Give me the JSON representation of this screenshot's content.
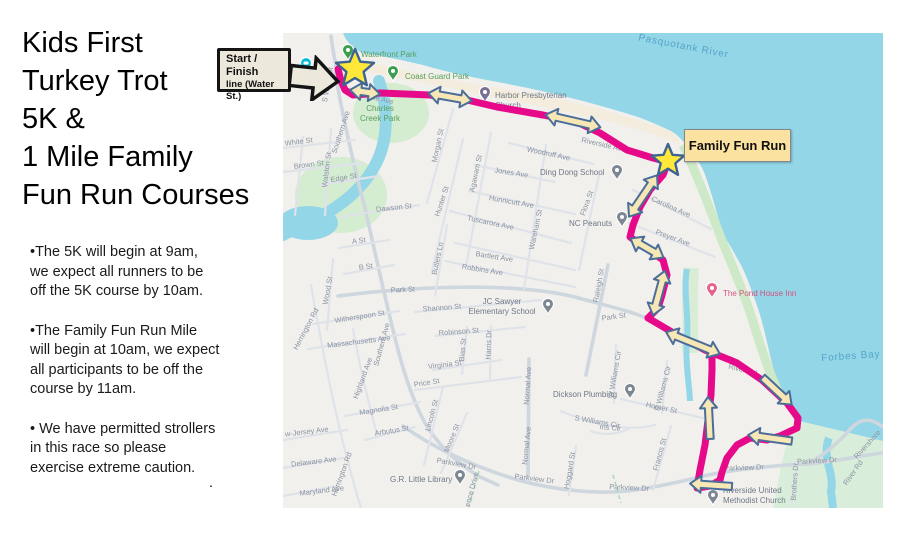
{
  "left_panel": {
    "title_lines": [
      "Kids First",
      "Turkey Trot",
      "5K &",
      "1 Mile Family",
      "Fun Run Courses"
    ],
    "bullets": [
      [
        "•The 5K will begin at 9am,",
        "we expect all runners to be",
        "off the 5K course by 10am."
      ],
      [
        "•The Family Fun Run Mile",
        "will begin at 10am, we expect",
        "all participants to be off the",
        "course by 11am."
      ],
      [
        "• We have permitted strollers",
        "in this race so please",
        "exercise extreme caution."
      ]
    ],
    "stray_period": "."
  },
  "annotations": {
    "start_finish_callout_lines": [
      "Start / Finish",
      "line (Water",
      "St.)"
    ],
    "family_fun_run_label": "Family Fun Run"
  },
  "map": {
    "colors": {
      "land": "#f1f0ed",
      "water": "#93d6e8",
      "park_green": "#d4ecd0",
      "shore_green": "#cde9c8",
      "beach_cream": "#f4ecdc",
      "road_minor": "#dfe3e9",
      "road_major": "#ced6de",
      "route_pink": "#e60a8a",
      "arrow_fill": "#f6e7b4",
      "arrow_stroke": "#4b6d99",
      "star_fill": "#ffe83a",
      "star_stroke": "#3f6391"
    },
    "water_labels": [
      {
        "t": "Pasquotank River",
        "x": 400,
        "y": 16,
        "r": 11
      },
      {
        "t": "Forbes Bay",
        "x": 568,
        "y": 326,
        "r": -4
      }
    ],
    "street_labels": [
      {
        "t": "S Water St",
        "x": 47,
        "y": 52,
        "r": -80
      },
      {
        "t": "Riverside Ave",
        "x": 88,
        "y": 66,
        "r": 14
      },
      {
        "t": "Riverside Ave",
        "x": 320,
        "y": 114,
        "r": 13
      },
      {
        "t": "Southern Ave",
        "x": 60,
        "y": 100,
        "r": -72
      },
      {
        "t": "Southern Ave",
        "x": 101,
        "y": 312,
        "r": -75
      },
      {
        "t": "Walston St",
        "x": 46,
        "y": 137,
        "r": -83
      },
      {
        "t": "White St",
        "x": 16,
        "y": 111,
        "r": -7
      },
      {
        "t": "Brown St",
        "x": 26,
        "y": 134,
        "r": -7
      },
      {
        "t": "Edge St",
        "x": 61,
        "y": 147,
        "r": -10
      },
      {
        "t": "Dawson St",
        "x": 111,
        "y": 177,
        "r": -6
      },
      {
        "t": "A St",
        "x": 76,
        "y": 210,
        "r": -7
      },
      {
        "t": "B St",
        "x": 83,
        "y": 236,
        "r": -7
      },
      {
        "t": "Morgan St",
        "x": 157,
        "y": 113,
        "r": -78
      },
      {
        "t": "Hunter St",
        "x": 161,
        "y": 169,
        "r": -72
      },
      {
        "t": "Butlers Ln",
        "x": 157,
        "y": 226,
        "r": -78
      },
      {
        "t": "Agawam St",
        "x": 195,
        "y": 141,
        "r": -78
      },
      {
        "t": "Jones Ave",
        "x": 228,
        "y": 142,
        "r": 9
      },
      {
        "t": "Hunnicutt Ave",
        "x": 228,
        "y": 171,
        "r": 10
      },
      {
        "t": "Tuscarora Ave",
        "x": 207,
        "y": 192,
        "r": 12
      },
      {
        "t": "Bartlett Ave",
        "x": 211,
        "y": 226,
        "r": 9
      },
      {
        "t": "Robbins Ave",
        "x": 199,
        "y": 239,
        "r": 9
      },
      {
        "t": "Woodruff Ave",
        "x": 265,
        "y": 123,
        "r": 12
      },
      {
        "t": "Wareham St",
        "x": 255,
        "y": 197,
        "r": -78
      },
      {
        "t": "Flora St",
        "x": 306,
        "y": 171,
        "r": -70
      },
      {
        "t": "Carolina Ave",
        "x": 387,
        "y": 176,
        "r": 24
      },
      {
        "t": "Preyer Ave",
        "x": 389,
        "y": 207,
        "r": 20
      },
      {
        "t": "Raleigh St",
        "x": 318,
        "y": 253,
        "r": -80
      },
      {
        "t": "Park St",
        "x": 120,
        "y": 259,
        "r": -3
      },
      {
        "t": "Park St",
        "x": 331,
        "y": 286,
        "r": -8
      },
      {
        "t": "Shannon St",
        "x": 159,
        "y": 277,
        "r": -4
      },
      {
        "t": "Witherspoon St",
        "x": 77,
        "y": 286,
        "r": -9
      },
      {
        "t": "Massachusetts Ave",
        "x": 76,
        "y": 311,
        "r": -7
      },
      {
        "t": "Herrington Rd",
        "x": 25,
        "y": 297,
        "r": -62
      },
      {
        "t": "Herrington Rd",
        "x": 61,
        "y": 442,
        "r": -70
      },
      {
        "t": "Wood St",
        "x": 47,
        "y": 258,
        "r": -80
      },
      {
        "t": "Highland Ave",
        "x": 82,
        "y": 346,
        "r": -70
      },
      {
        "t": "Robinson St",
        "x": 176,
        "y": 301,
        "r": -4
      },
      {
        "t": "Bias St",
        "x": 182,
        "y": 317,
        "r": -85
      },
      {
        "t": "Harris Dr",
        "x": 208,
        "y": 312,
        "r": -88
      },
      {
        "t": "Virginia St",
        "x": 162,
        "y": 334,
        "r": -7
      },
      {
        "t": "Price St",
        "x": 144,
        "y": 352,
        "r": -9
      },
      {
        "t": "Normal Ave",
        "x": 247,
        "y": 353,
        "r": -86
      },
      {
        "t": "Normal Ave",
        "x": 246,
        "y": 413,
        "r": -84
      },
      {
        "t": "Magnolia St",
        "x": 96,
        "y": 379,
        "r": -9
      },
      {
        "t": "Lincoln St",
        "x": 151,
        "y": 383,
        "r": -75
      },
      {
        "t": "Moore St",
        "x": 171,
        "y": 406,
        "r": -68
      },
      {
        "t": "w-Jersey Ave",
        "x": 24,
        "y": 401,
        "r": -7
      },
      {
        "t": "Delaware Ave",
        "x": 31,
        "y": 431,
        "r": -7
      },
      {
        "t": "Maryland Ave",
        "x": 39,
        "y": 460,
        "r": -7
      },
      {
        "t": "Arbutus St",
        "x": 109,
        "y": 400,
        "r": -9
      },
      {
        "t": "Parkview Dr",
        "x": 173,
        "y": 433,
        "r": 10
      },
      {
        "t": "Parkview Dr",
        "x": 251,
        "y": 448,
        "r": 7
      },
      {
        "t": "Parkview Dr",
        "x": 346,
        "y": 457,
        "r": 3
      },
      {
        "t": "Parkview Dr",
        "x": 461,
        "y": 437,
        "r": -2
      },
      {
        "t": "Parkview Dr",
        "x": 534,
        "y": 430,
        "r": -3
      },
      {
        "t": "Hoggard St",
        "x": 289,
        "y": 438,
        "r": -80
      },
      {
        "t": "S Williams Cir",
        "x": 314,
        "y": 391,
        "r": 10
      },
      {
        "t": "ms Cir",
        "x": 327,
        "y": 397,
        "r": 5
      },
      {
        "t": "Horner St",
        "x": 378,
        "y": 377,
        "r": 12
      },
      {
        "t": "W Williams Cir",
        "x": 334,
        "y": 342,
        "r": -80
      },
      {
        "t": "E Williams Cir",
        "x": 382,
        "y": 356,
        "r": -75
      },
      {
        "t": "Francis St",
        "x": 379,
        "y": 422,
        "r": -75
      },
      {
        "t": "Brothers Dr",
        "x": 514,
        "y": 449,
        "r": -86
      },
      {
        "t": "ence Drive",
        "x": 191,
        "y": 457,
        "r": -75
      },
      {
        "t": "River Rd",
        "x": 459,
        "y": 339,
        "r": 14
      },
      {
        "t": "River Rd",
        "x": 572,
        "y": 441,
        "r": -55
      },
      {
        "t": "Rivershore",
        "x": 586,
        "y": 413,
        "r": -48
      }
    ],
    "places": [
      {
        "name": "waterfront-park",
        "pin": "park",
        "px": 65,
        "py": 27,
        "lines": [
          "Waterfront Park"
        ],
        "tx": 78,
        "ty": 24,
        "cls": "lbl-park"
      },
      {
        "name": "coast-guard-park",
        "pin": "park",
        "px": 110,
        "py": 48,
        "lines": [
          "Coast Guard Park"
        ],
        "tx": 122,
        "ty": 46,
        "cls": "lbl-park"
      },
      {
        "name": "charles-creek-park",
        "pin": "none",
        "px": 0,
        "py": 0,
        "lines": [
          "Charles",
          "Creek Park"
        ],
        "tx": 97,
        "ty": 78,
        "cls": "lbl-park",
        "anchor": "middle"
      },
      {
        "name": "harbor-presbyterian-church",
        "pin": "church",
        "px": 202,
        "py": 69,
        "lines": [
          "Harbor Presbyterian",
          "Church"
        ],
        "tx": 212,
        "ty": 65,
        "cls": "lbl-poi"
      },
      {
        "name": "ding-dong-school",
        "pin": "gray",
        "px": 334,
        "py": 147,
        "lines": [
          "Ding Dong School"
        ],
        "tx": 257,
        "ty": 142,
        "cls": "lbl-poi"
      },
      {
        "name": "nc-peanuts",
        "pin": "gray",
        "px": 339,
        "py": 194,
        "lines": [
          "NC Peanuts"
        ],
        "tx": 286,
        "ty": 193,
        "cls": "lbl-poi"
      },
      {
        "name": "jc-sawyer-elementary-school",
        "pin": "gray",
        "px": 265,
        "py": 281,
        "lines": [
          "JC Sawyer",
          "Elementary School"
        ],
        "tx": 219,
        "ty": 271,
        "cls": "lbl-poi",
        "anchor": "middle"
      },
      {
        "name": "the-pond-house-inn",
        "pin": "pink",
        "px": 429,
        "py": 265,
        "lines": [
          "The Pond House Inn"
        ],
        "tx": 440,
        "ty": 263,
        "cls": "lbl-pink"
      },
      {
        "name": "dickson-plumbing",
        "pin": "gray",
        "px": 347,
        "py": 366,
        "lines": [
          "Dickson Plumbing"
        ],
        "tx": 270,
        "ty": 364,
        "cls": "lbl-poi"
      },
      {
        "name": "gr-little-library",
        "pin": "gray",
        "px": 177,
        "py": 452,
        "lines": [
          "G.R. Little Library"
        ],
        "tx": 107,
        "ty": 449,
        "cls": "lbl-poi"
      },
      {
        "name": "riverside-united-methodist-church",
        "pin": "gray",
        "px": 430,
        "py": 472,
        "lines": [
          "Riverside United",
          "Methodist Church"
        ],
        "tx": 440,
        "ty": 460,
        "cls": "lbl-poi"
      },
      {
        "name": "lodging",
        "pin": "teal-circle",
        "px": 23,
        "py": 30,
        "lines": [],
        "tx": 0,
        "ty": 0,
        "cls": "lbl-poi"
      }
    ],
    "route": {
      "paths": [
        "M55,36 L58,48 L62,57 L70,62 L97,60 L147,62 L184,67 L214,74 L260,82 L294,89 L317,100 L344,117 L370,125 L385,129",
        "M385,129 L380,142 L367,157 L357,174 L350,192 L347,204 L370,220 L380,227 L384,242 L379,262 L375,275 L365,285",
        "M365,285 L394,302 L422,317 L447,327 L454,330 L479,347 L504,370 L515,385 L514,395 L497,403 L484,407 L467,405 L454,412 L444,425 L439,439 L437,447 L427,453 L414,455 L417,437 L422,412 L425,387 L428,362 L429,337 L429,319 L422,317"
      ]
    },
    "arrows": [
      {
        "x": 82,
        "y": 59,
        "a": 8,
        "len": 30,
        "double": true
      },
      {
        "x": 167,
        "y": 64,
        "a": 10,
        "len": 44,
        "double": true
      },
      {
        "x": 290,
        "y": 88,
        "a": 13,
        "len": 56,
        "double": true
      },
      {
        "x": 360,
        "y": 163,
        "a": -56,
        "len": 50,
        "double": true
      },
      {
        "x": 364,
        "y": 215,
        "a": 30,
        "len": 38,
        "double": true
      },
      {
        "x": 376,
        "y": 260,
        "a": -75,
        "len": 46,
        "double": true
      },
      {
        "x": 410,
        "y": 310,
        "a": 22,
        "len": 58,
        "double": true
      },
      {
        "x": 494,
        "y": 358,
        "a": 43,
        "len": 40,
        "double": false
      },
      {
        "x": 487,
        "y": 405,
        "a": 188,
        "len": 44,
        "double": false
      },
      {
        "x": 428,
        "y": 452,
        "a": 184,
        "len": 42,
        "double": false
      },
      {
        "x": 426,
        "y": 385,
        "a": -93,
        "len": 42,
        "double": false
      }
    ],
    "stars": [
      {
        "name": "start-finish-star",
        "x": 72,
        "y": 36,
        "r": 20
      },
      {
        "name": "family-fun-run-star",
        "x": 385,
        "y": 128,
        "r": 17
      }
    ]
  }
}
